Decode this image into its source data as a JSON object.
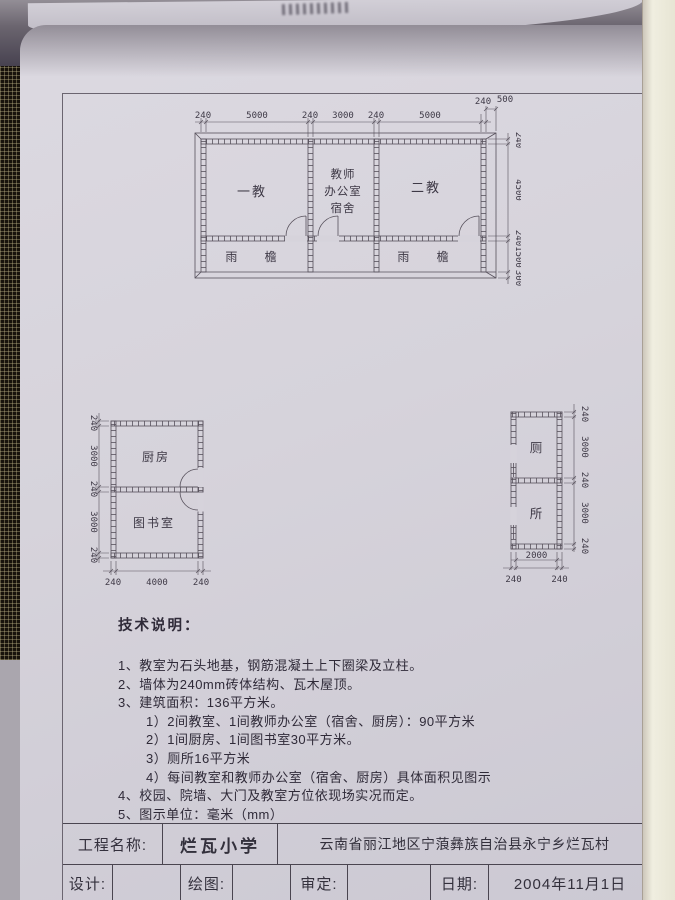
{
  "colors": {
    "paper": "#d6d3db",
    "ink_line": "#57515c",
    "text": "#2f2a38",
    "mesh_background": "#17120b",
    "window_frame": "#f0eee0"
  },
  "plans": {
    "main": {
      "room_left": "一教",
      "office_line1": "教师",
      "office_line2": "办公室",
      "office_line3": "宿舍",
      "room_right": "二教",
      "eave": "雨 檐",
      "dims_top": [
        "240",
        "5000",
        "240",
        "3000",
        "240",
        "5000",
        "240"
      ],
      "dim_overhang": "500",
      "dims_right": [
        "240",
        "4500",
        "240",
        "1500",
        "300"
      ]
    },
    "annex": {
      "room_top": "厨房",
      "room_bottom": "图书室",
      "dims_left": [
        "240",
        "3000",
        "240",
        "3000",
        "240"
      ],
      "dims_bottom": [
        "240",
        "4000",
        "240"
      ]
    },
    "toilet": {
      "room_top": "厕",
      "room_bottom": "所",
      "dims_right": [
        "240",
        "3000",
        "240",
        "3000",
        "240"
      ],
      "dim_width": "2000",
      "dims_bottom": [
        "240",
        "240"
      ]
    }
  },
  "notes": {
    "heading": "技术说明：",
    "items": [
      "1、教室为石头地基，钢筋混凝土上下圈梁及立柱。",
      "2、墙体为240mm砖体结构、瓦木屋顶。",
      "3、建筑面积：136平方米。",
      "1）2间教室、1间教师办公室（宿舍、厨房）：90平方米",
      "2）1间厨房、1间图书室30平方米。",
      "3）厕所16平方米",
      "4）每间教室和教师办公室（宿舍、厨房）具体面积见图示",
      "4、校园、院墙、大门及教室方位依现场实况而定。",
      "5、图示单位：毫米（mm）"
    ]
  },
  "title_block": {
    "project_label": "工程名称:",
    "project_name": "烂瓦小学",
    "location": "云南省丽江地区宁蒗彝族自治县永宁乡烂瓦村",
    "design_label": "设计:",
    "draw_label": "绘图:",
    "review_label": "审定:",
    "date_label": "日期:",
    "date_value": "2004年11月1日",
    "design_value": "",
    "draw_value": "",
    "review_value": ""
  }
}
